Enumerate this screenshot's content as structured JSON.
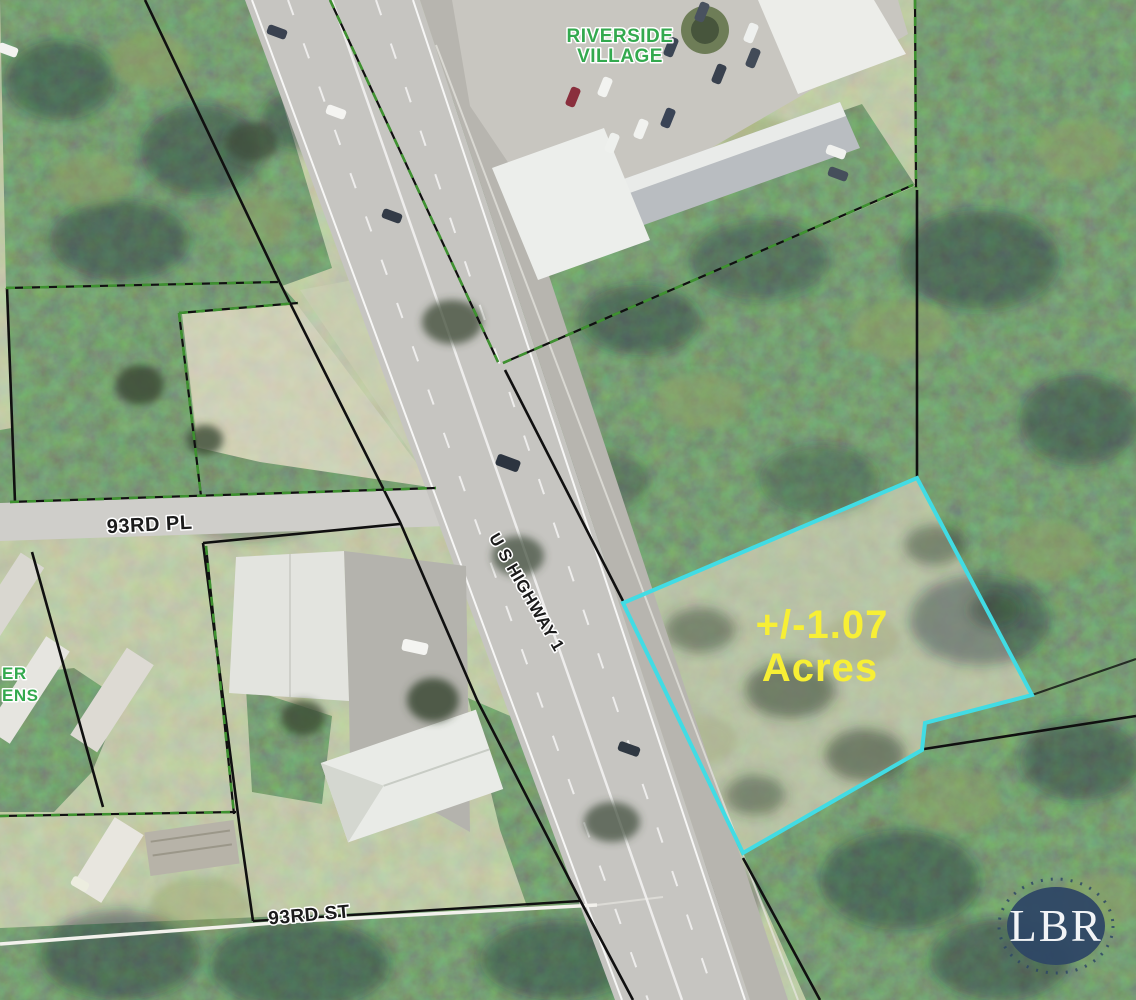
{
  "map": {
    "labels": {
      "riverside_line1": "RIVERSIDE",
      "riverside_line2": "VILLAGE",
      "street_93rd_pl": "93RD PL",
      "street_93rd_st": "93RD ST",
      "highway": "U S HIGHWAY 1",
      "partial_left_line1": "ER",
      "partial_left_line2": "ENS"
    },
    "parcel": {
      "acreage_line1": "+/-1.07",
      "acreage_line2": "Acres",
      "acreage_value": "1.07"
    },
    "logo": {
      "text": "LBR"
    },
    "colors": {
      "parcel_highlight": "#41DCE4",
      "acreage_text": "#F7EF35",
      "label_green": "#33A94E",
      "boundary_black": "#101010",
      "boundary_green_dash": "#3E9130",
      "logo_navy": "#2E4765"
    }
  }
}
